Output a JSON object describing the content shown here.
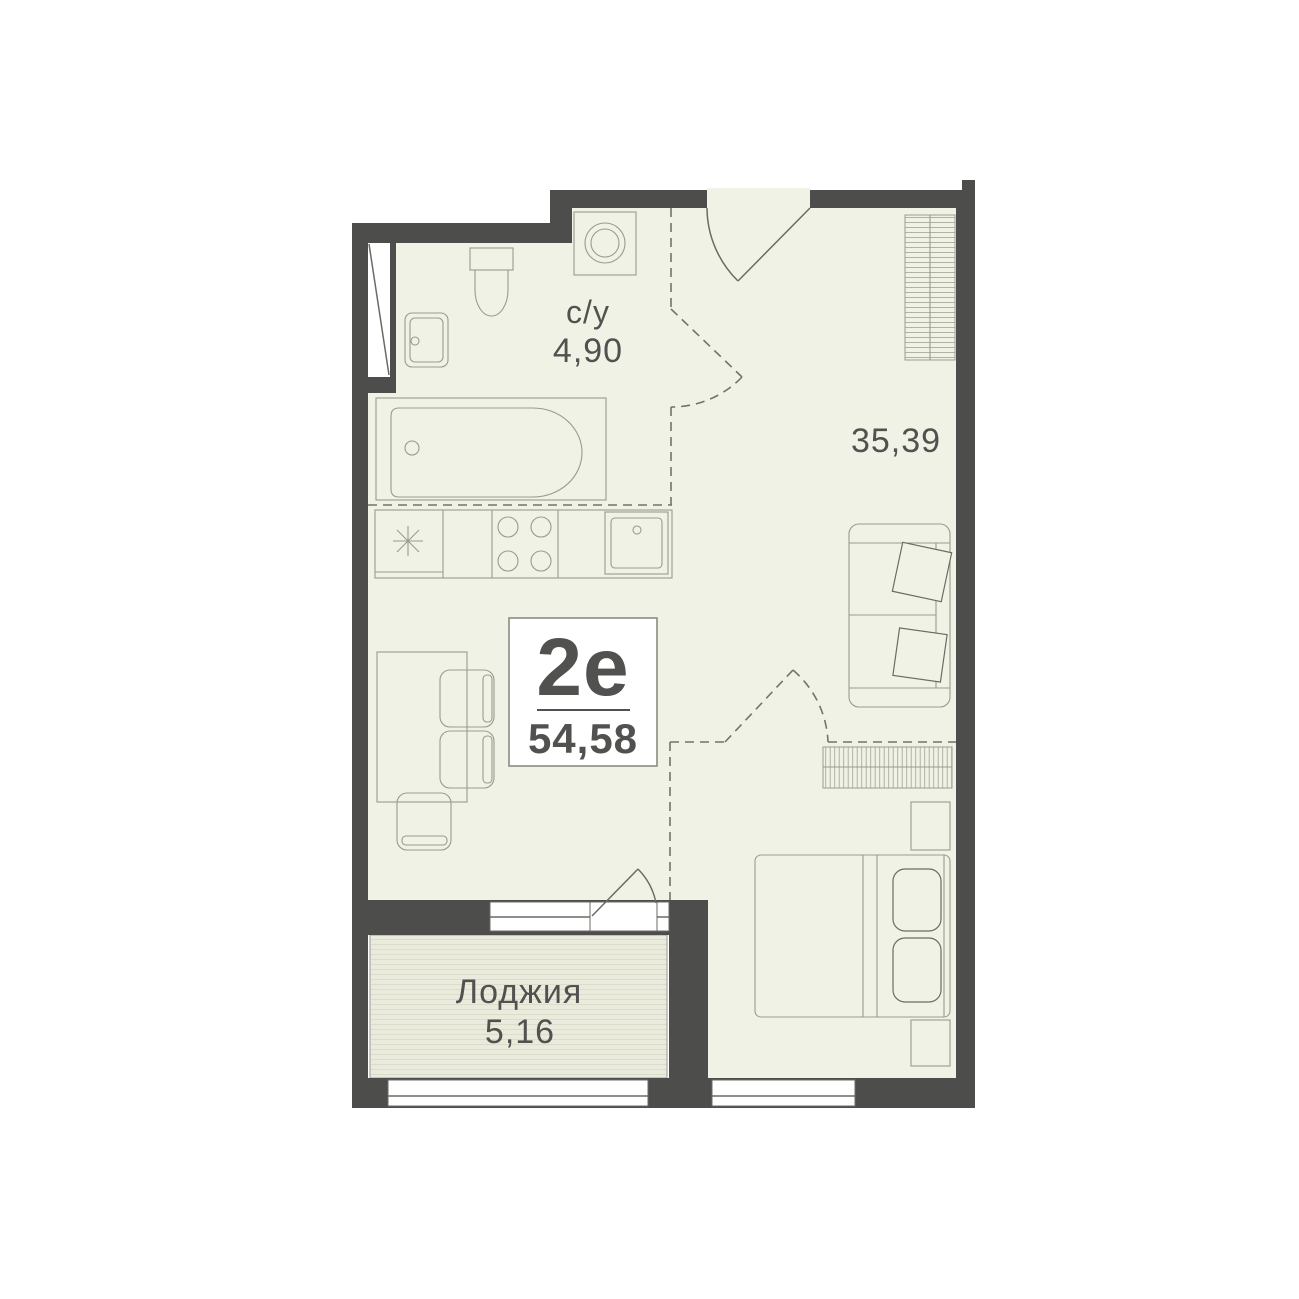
{
  "plan": {
    "unit_type": "2е",
    "unit_area": "54,58",
    "bathroom_name": "с/у",
    "bathroom_area": "4,90",
    "living_area": "35,39",
    "loggia_name": "Лоджия",
    "loggia_area": "5,16"
  },
  "colors": {
    "wall": "#4d4d4b",
    "floor": "#f1f2e6",
    "loggia": "#ebebdd",
    "stripe": "#dcdccb",
    "line": "#9a9a8f",
    "dkline": "#6b6b64",
    "dash": "#73736c",
    "text": "#515150",
    "boxborder": "#8b8b82"
  }
}
